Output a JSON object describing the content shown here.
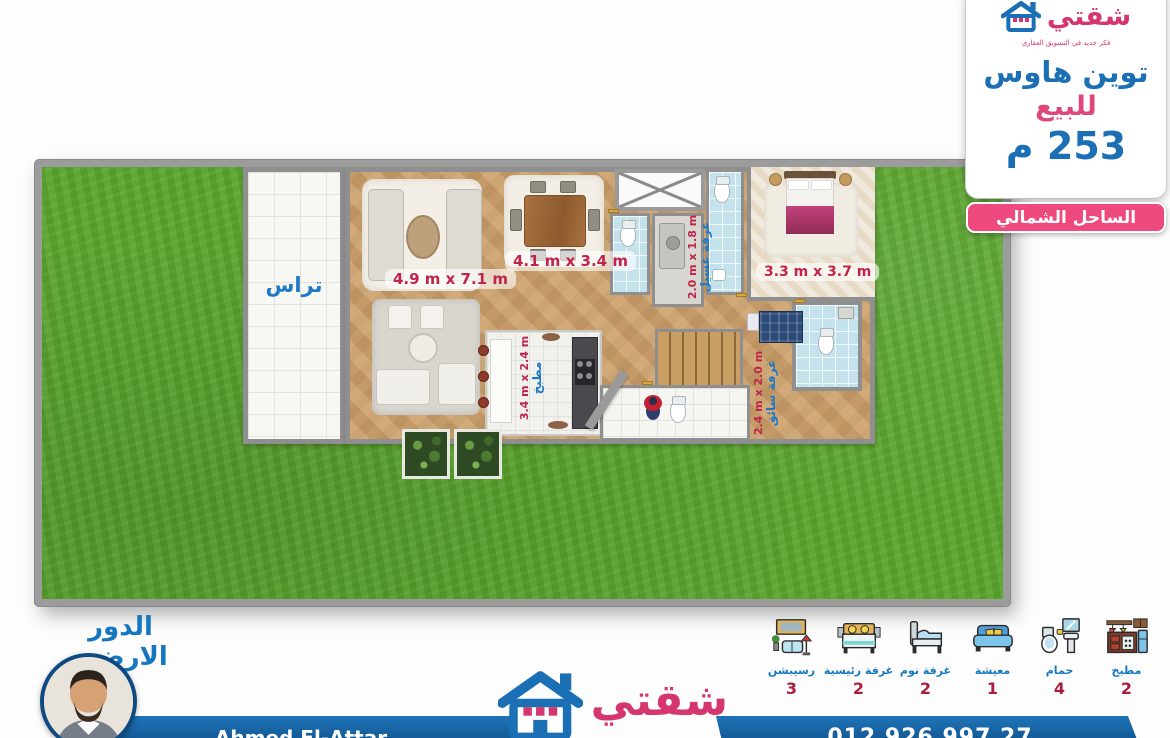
{
  "header_card": {
    "brand_name": "شقتي",
    "brand_tagline": "فكر جديد في التسويق العقاري",
    "title": "توين هاوس",
    "subtitle": "للبيع",
    "area": "253 م",
    "badge": "الساحل الشمالي"
  },
  "plan": {
    "floor_title": "الدور الارضي",
    "rooms": {
      "terrace": "تراس",
      "living_dims": "4.9 m x 7.1 m",
      "dining_dims": "4.1 m x 3.4 m",
      "kitchen": "مطبخ",
      "kitchen_dims": "3.4 m x 2.4 m",
      "laundry": "غرفة غسيل",
      "laundry_dims": "2.0 m x 1.8 m",
      "master_dims": "3.3 m x 3.7 m",
      "driver": "غرفة سائق",
      "driver_dims": "2.4 m x 2.0 m"
    }
  },
  "legend": {
    "items": [
      {
        "name": "reception",
        "label": "رسيبشن",
        "count": "3"
      },
      {
        "name": "master-bedroom",
        "label": "غرفة رئيسية",
        "count": "2"
      },
      {
        "name": "bedroom",
        "label": "غرفة نوم",
        "count": "2"
      },
      {
        "name": "living",
        "label": "معيشة",
        "count": "1"
      },
      {
        "name": "bathroom",
        "label": "حمام",
        "count": "4"
      },
      {
        "name": "kitchen",
        "label": "مطبخ",
        "count": "2"
      }
    ]
  },
  "footer": {
    "agent_name": "Ahmed El-Attar",
    "phone": "012 926 997 27",
    "brand_name": "شقتي"
  },
  "colors": {
    "brand_blue": "#1a6fb5",
    "brand_pink": "#d6366f",
    "badge_pink": "#ee4a7d",
    "count_red": "#a81e3e",
    "dim_red": "#c0244b",
    "grass_green": "#5aa42e"
  }
}
